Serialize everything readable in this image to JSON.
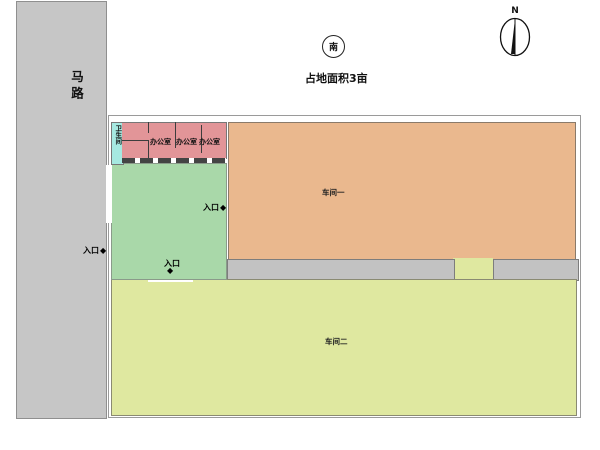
{
  "plan": {
    "title_note": "占地面积3亩",
    "south_marker": "南",
    "compass_north": "N"
  },
  "road": {
    "label": "马路",
    "color": "#c6c6c6"
  },
  "rooms": {
    "toilet": {
      "label": "卫生间",
      "color": "#a6e9e1"
    },
    "offices": [
      {
        "label": "办公室"
      },
      {
        "label": "办公室"
      },
      {
        "label": "办公室"
      }
    ],
    "office_color": "#e29598",
    "workshop1": {
      "label": "车间一",
      "color": "#eab88e"
    },
    "workshop2": {
      "label": "车间二",
      "color": "#dfe8a0"
    },
    "courtyard_color": "#a9d8a9",
    "corridor_color": "#c2c2c2"
  },
  "entrances": [
    {
      "label": "入口",
      "marker": "◆",
      "position": "road-side-west"
    },
    {
      "label": "入口",
      "marker": "◆",
      "position": "courtyard-east-to-workshop1"
    },
    {
      "label": "入口",
      "marker": "◆",
      "position": "courtyard-south-to-workshop2"
    }
  ]
}
